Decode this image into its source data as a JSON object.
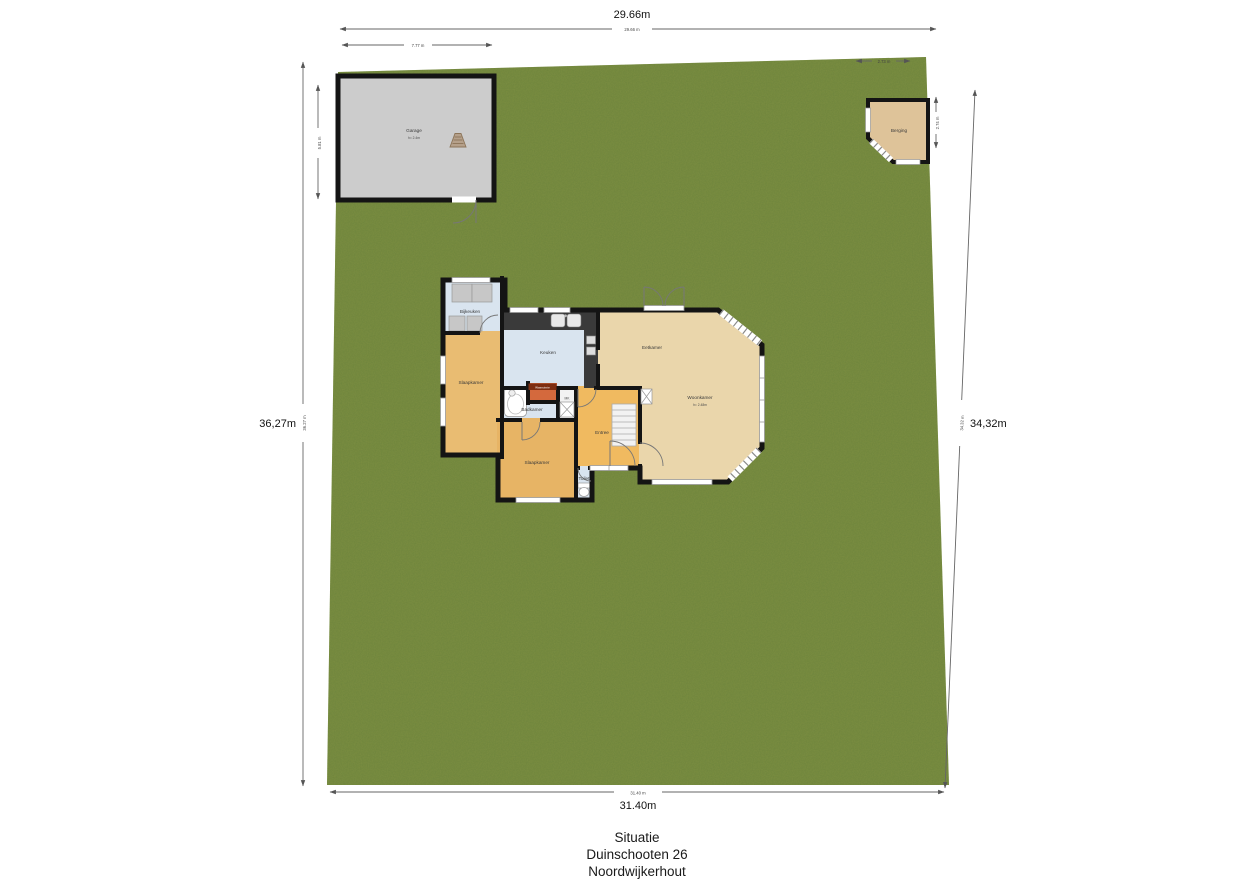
{
  "site": {
    "dims": {
      "top_big": "29.66m",
      "top_small": "29.66 m",
      "left_big": "36,27m",
      "left_small": "36.27 m",
      "right_big": "34,32m",
      "right_small": "34.32 m",
      "bottom_big": "31.40m",
      "bottom_small": "31.40 m",
      "garage_width": "7.77 m",
      "garage_height": "5.81 m",
      "shed_width": "2.73 m",
      "shed_height": "2.74 m"
    }
  },
  "garage": {
    "label": "Garage",
    "sublabel": "h= 2.4m"
  },
  "shed": {
    "label": "Berging"
  },
  "house": {
    "rooms": {
      "bijkeuken": "Bijkeuken",
      "keuken": "Keuken",
      "eetkamer": "Eetkamer",
      "woonkamer": "Woonkamer",
      "woonkamer_sub": "h= 2.48m",
      "slaapkamer_left": "Slaapkamer",
      "slaapkamer_bottom": "Slaapkamer",
      "badkamer": "Badkamer",
      "wasruimte": "Wasruimte",
      "entree": "Entree",
      "toilet": "Toilet",
      "meterkast": "MK"
    }
  },
  "title": {
    "line1": "Situatie",
    "line2": "Duinschooten 26",
    "line3": "Noordwijkerhout"
  },
  "colors": {
    "grass": "#7c8e41",
    "garage_fill": "#cccccc",
    "shed_fill": "#dec399",
    "room_blue": "#d9e4ef",
    "room_orange": "#eeb863",
    "room_tan": "#ead6ab",
    "utility_red": "#d4693d",
    "utility_band": "#7d2e12",
    "wall": "#141414"
  }
}
